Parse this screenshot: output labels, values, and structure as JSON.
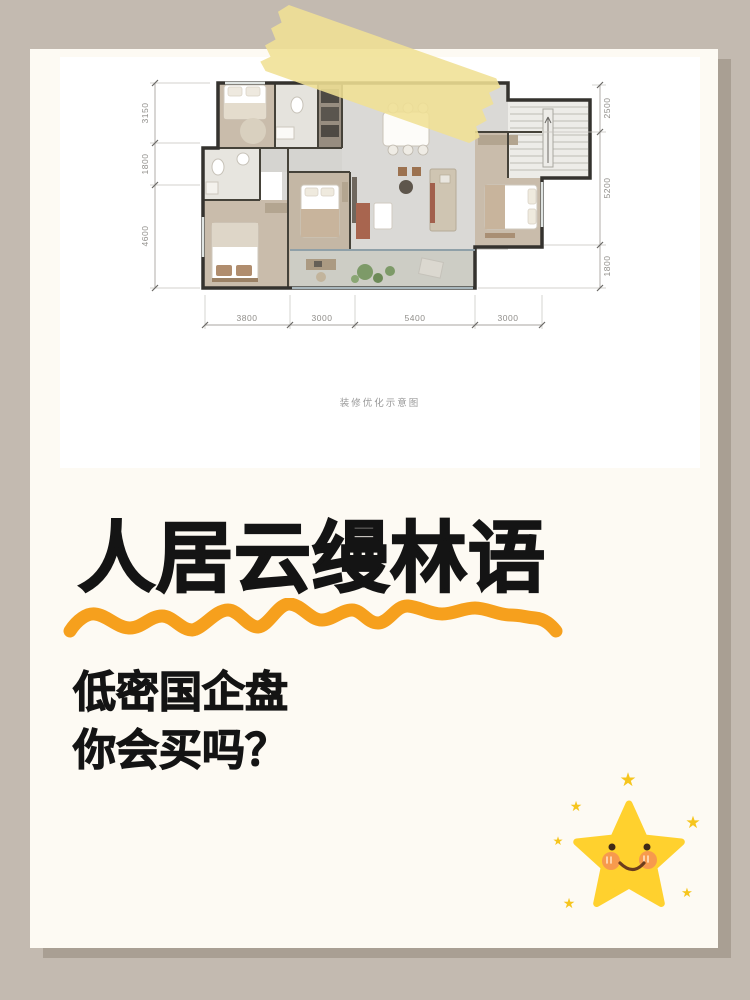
{
  "poster": {
    "title": "人居云缦林语",
    "subtitle_lines": [
      "低密国企盘",
      "你会买吗？"
    ]
  },
  "floorplan": {
    "caption": "装修优化示意图",
    "dims_left": [
      "3150",
      "1800",
      "4600"
    ],
    "dims_right": [
      "2500",
      "5200",
      "1800"
    ],
    "dims_bottom": [
      "3800",
      "3000",
      "5400",
      "3000"
    ]
  },
  "icons": {
    "sparkle": "★"
  },
  "colors": {
    "background": "#c3bab0",
    "card": "#fdfaf3",
    "card_shadow": "#a99f93",
    "accent_orange": "#f6a01d",
    "star_yellow": "#ffd12e",
    "tape_yellow": "#f0e094",
    "text_black": "#141414"
  }
}
